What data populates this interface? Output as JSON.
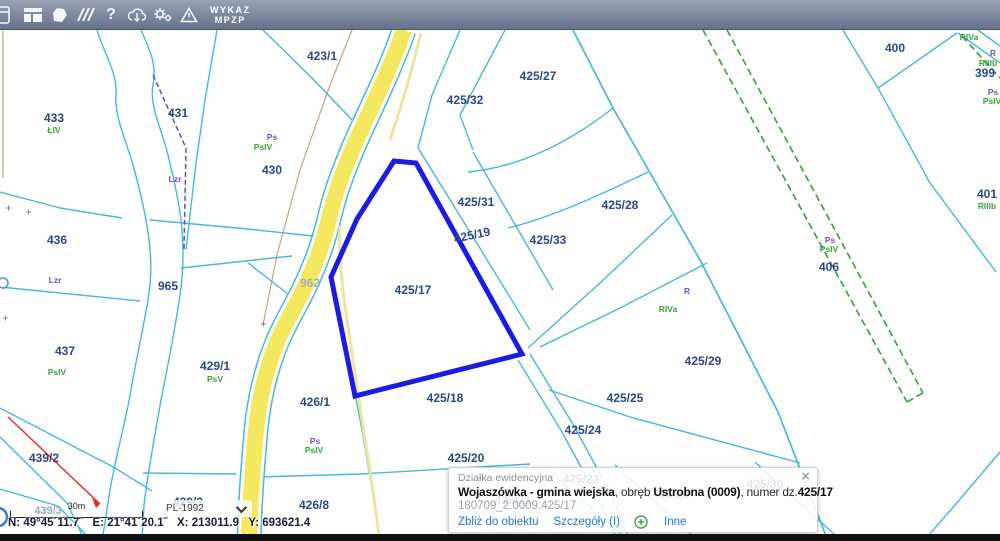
{
  "toolbar": {
    "icons": [
      {
        "name": "window-partial-icon"
      },
      {
        "name": "layout-panels-icon"
      },
      {
        "name": "polygon-select-icon"
      },
      {
        "name": "measure-lines-icon"
      },
      {
        "name": "help-icon"
      },
      {
        "name": "download-cloud-icon"
      },
      {
        "name": "settings-gears-icon"
      },
      {
        "name": "warning-icon"
      }
    ],
    "wykaz_label": "WYKAZ\nMPZP"
  },
  "colors": {
    "boundary_cyan": "#46b8d8",
    "highlight_blue": "#1b1be6",
    "road_yellow": "#f4e85e",
    "green_dashed": "#35a035",
    "purple_dashed": "#5b4fc0",
    "tan_line": "#cfa27a",
    "red_line": "#e03030",
    "link_blue": "#2176d2",
    "label_navy": "#2c4687"
  },
  "map": {
    "labels": [
      {
        "text": "423/1",
        "x": 322,
        "y": 60,
        "cls": "parcel"
      },
      {
        "text": "433",
        "x": 54,
        "y": 122,
        "cls": "parcel"
      },
      {
        "text": "ŁIV",
        "x": 54,
        "y": 133,
        "cls": "green"
      },
      {
        "text": "431",
        "x": 178,
        "y": 117,
        "cls": "parcel"
      },
      {
        "text": "Ps",
        "x": 272,
        "y": 140,
        "cls": "purple"
      },
      {
        "text": "PsIV",
        "x": 263,
        "y": 150,
        "cls": "green"
      },
      {
        "text": "430",
        "x": 272,
        "y": 174,
        "cls": "parcel"
      },
      {
        "text": "436",
        "x": 57,
        "y": 244,
        "cls": "parcel"
      },
      {
        "text": "Lzr",
        "x": 175,
        "y": 182,
        "cls": "purple"
      },
      {
        "text": "Lzr",
        "x": 55,
        "y": 283,
        "cls": "purple"
      },
      {
        "text": "965",
        "x": 168,
        "y": 290,
        "cls": "parcel"
      },
      {
        "text": "962",
        "x": 310,
        "y": 287,
        "cls": "gray"
      },
      {
        "text": "437",
        "x": 65,
        "y": 355,
        "cls": "parcel"
      },
      {
        "text": "PsIV",
        "x": 57,
        "y": 375,
        "cls": "green"
      },
      {
        "text": "429/1",
        "x": 215,
        "y": 370,
        "cls": "parcel"
      },
      {
        "text": "PsV",
        "x": 215,
        "y": 382,
        "cls": "green"
      },
      {
        "text": "439/2",
        "x": 44,
        "y": 462,
        "cls": "parcel"
      },
      {
        "text": "439/4",
        "x": -20,
        "y": 499,
        "cls": "parcel"
      },
      {
        "text": "439/3",
        "x": 48,
        "y": 514,
        "cls": "muted"
      },
      {
        "text": "429/3",
        "x": 188,
        "y": 506,
        "cls": "parcel"
      },
      {
        "text": "426/1",
        "x": 315,
        "y": 406,
        "cls": "parcel"
      },
      {
        "text": "Ps",
        "x": 315,
        "y": 444,
        "cls": "purple"
      },
      {
        "text": "PsIV",
        "x": 314,
        "y": 453,
        "cls": "green"
      },
      {
        "text": "426/8",
        "x": 314,
        "y": 509,
        "cls": "parcel"
      },
      {
        "text": "425/17",
        "x": 413,
        "y": 294,
        "cls": "parcel"
      },
      {
        "text": "425/18",
        "x": 445,
        "y": 402,
        "cls": "parcel"
      },
      {
        "text": "425/20",
        "x": 466,
        "y": 462,
        "cls": "parcel"
      },
      {
        "text": "425/32",
        "x": 465,
        "y": 104,
        "cls": "parcel"
      },
      {
        "text": "425/27",
        "x": 538,
        "y": 80,
        "cls": "parcel"
      },
      {
        "text": "425/31",
        "x": 476,
        "y": 206,
        "cls": "parcel"
      },
      {
        "text": "425/19",
        "x": 473,
        "y": 239,
        "cls": "parcel",
        "rot": -12
      },
      {
        "text": "425/33",
        "x": 548,
        "y": 244,
        "cls": "parcel"
      },
      {
        "text": "425/28",
        "x": 620,
        "y": 209,
        "cls": "parcel"
      },
      {
        "text": "425/25",
        "x": 625,
        "y": 402,
        "cls": "parcel"
      },
      {
        "text": "425/24",
        "x": 583,
        "y": 434,
        "cls": "parcel"
      },
      {
        "text": "425/29",
        "x": 703,
        "y": 365,
        "cls": "parcel"
      },
      {
        "text": "R",
        "x": 687,
        "y": 294,
        "cls": "purple"
      },
      {
        "text": "RIVa",
        "x": 668,
        "y": 312,
        "cls": "green"
      },
      {
        "text": "400",
        "x": 895,
        "y": 52,
        "cls": "parcel"
      },
      {
        "text": "RIVa",
        "x": 969,
        "y": 40,
        "cls": "green"
      },
      {
        "text": "R",
        "x": 993,
        "y": 56,
        "cls": "purple"
      },
      {
        "text": "RIIIb",
        "x": 988,
        "y": 66,
        "cls": "green"
      },
      {
        "text": "399",
        "x": 985,
        "y": 77,
        "cls": "parcel"
      },
      {
        "text": "Ps",
        "x": 993,
        "y": 95,
        "cls": "purple"
      },
      {
        "text": "PsIV",
        "x": 992,
        "y": 104,
        "cls": "green"
      },
      {
        "text": "401",
        "x": 987,
        "y": 198,
        "cls": "parcel"
      },
      {
        "text": "RIIIb",
        "x": 987,
        "y": 209,
        "cls": "green"
      },
      {
        "text": "Ps",
        "x": 830,
        "y": 243,
        "cls": "purple"
      },
      {
        "text": "PsIV",
        "x": 829,
        "y": 252,
        "cls": "green"
      },
      {
        "text": "406",
        "x": 829,
        "y": 271,
        "cls": "parcel"
      },
      {
        "text": "425/23",
        "x": 581,
        "y": 483,
        "cls": "parcel"
      },
      {
        "text": "425/21",
        "x": 513,
        "y": 504,
        "cls": "parcel"
      },
      {
        "text": "425/26",
        "x": 671,
        "y": 498,
        "cls": "parcel"
      },
      {
        "text": "425/30",
        "x": 765,
        "y": 488,
        "cls": "parcel"
      }
    ],
    "highlighted_parcel": "425/17"
  },
  "popup": {
    "title": "Działka ewidencyjna",
    "close_glyph": "×",
    "line": {
      "bold1": "Wojaszówka - gmina wiejska",
      "sep1": ", obręb ",
      "bold2": "Ustrobna (0009)",
      "sep2": ", numer dz.",
      "bold3": "425/17"
    },
    "object_id": "180709_2.0009.425/17",
    "links": {
      "zoom_to": "Zbliż do obiektu",
      "details": "Szczegóły (I)",
      "other": "Inne"
    }
  },
  "scalebar": {
    "label": "30m"
  },
  "projection": {
    "value": "PL-1992"
  },
  "statusbar": {
    "coordinates": "N: 49°45´11.7˝   E: 21°41´20.1˝   X: 213011.9   Y: 693621.4"
  }
}
